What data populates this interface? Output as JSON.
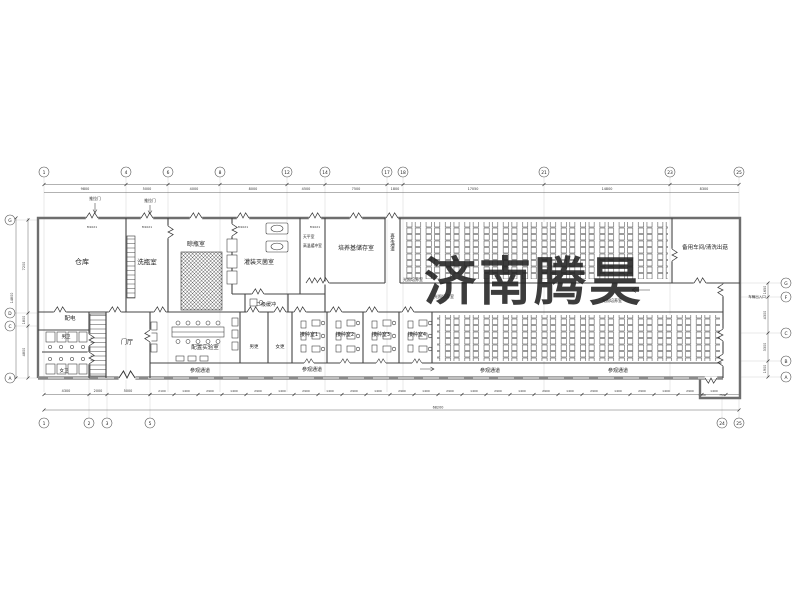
{
  "watermark": {
    "text": "济南腾昊",
    "color": "#e04848"
  },
  "colors": {
    "watermark_red": "#e04848",
    "wall_gray": "#6e6e6e",
    "line_dark": "#444"
  },
  "rooms": {
    "warehouse": "仓库",
    "bottle_wash": "洗瓶室",
    "bottle_dry": "晾瓶室",
    "filling_sterilize": "灌装灭菌室",
    "medium_storage": "培养基储存室",
    "spare_workshop": "备用车间/清洗出菇",
    "power_room": "配电",
    "wc_men": "男卫",
    "wc_women": "女卫",
    "lobby": "门厅",
    "prep_lab": "配置实验室",
    "buffer2": "二级缓冲",
    "change_men": "男更",
    "change_women": "女更",
    "inoc1": "接种室1",
    "inoc2": "接种室2",
    "inoc3": "接种室3",
    "inoc4": "接种室4"
  },
  "corridors": {
    "regen": "再生通道",
    "visitor": [
      "参观通道",
      "参观通道",
      "参观通道",
      "参观通道"
    ],
    "light_room": [
      "光照培养室",
      "光照培养室",
      "光照培养室"
    ]
  },
  "small_labels": {
    "sliding_door": [
      "推拉门",
      "推拉门"
    ],
    "balance_room": "天平室",
    "hot_buffer": "高温缓冲室",
    "vehicle_entry": "车辆出入口",
    "door_tag": "M1021"
  },
  "grid": {
    "top": [
      {
        "n": "1",
        "x": 44
      },
      {
        "n": "4",
        "x": 126
      },
      {
        "n": "6",
        "x": 168
      },
      {
        "n": "8",
        "x": 220
      },
      {
        "n": "12",
        "x": 287
      },
      {
        "n": "14",
        "x": 325
      },
      {
        "n": "17",
        "x": 387
      },
      {
        "n": "18",
        "x": 403
      },
      {
        "n": "21",
        "x": 544
      },
      {
        "n": "23",
        "x": 670
      },
      {
        "n": "25",
        "x": 739
      }
    ],
    "bottom": [
      {
        "n": "1",
        "x": 44
      },
      {
        "n": "2",
        "x": 89
      },
      {
        "n": "3",
        "x": 107
      },
      {
        "n": "5",
        "x": 150
      },
      {
        "n": "24",
        "x": 722
      },
      {
        "n": "25",
        "x": 739
      }
    ],
    "left": [
      {
        "n": "G",
        "y": 220
      },
      {
        "n": "D",
        "y": 313
      },
      {
        "n": "C",
        "y": 326
      },
      {
        "n": "A",
        "y": 378
      }
    ],
    "right": [
      {
        "n": "G",
        "y": 283
      },
      {
        "n": "F",
        "y": 297
      },
      {
        "n": "C",
        "y": 333
      },
      {
        "n": "B",
        "y": 361
      },
      {
        "n": "A",
        "y": 377
      }
    ]
  },
  "dims": {
    "top": [
      "9800",
      "5000",
      "4000",
      "8000",
      "4500",
      "7500",
      "1800",
      "17050",
      "14800",
      "8300"
    ],
    "bottom_left": [
      "4300",
      "2000",
      "5000"
    ],
    "bottom_small": [
      "2100",
      "1400",
      "2900",
      "1400",
      "2900",
      "1400",
      "2900",
      "1400",
      "2900",
      "1400",
      "2900",
      "1400",
      "2900",
      "1400",
      "2900",
      "1400",
      "2900",
      "1400",
      "2900",
      "1400",
      "2900",
      "1400",
      "2900",
      "1400"
    ],
    "total": "68200",
    "left": [
      "7200",
      "1800",
      "4800"
    ],
    "left_total": "14800",
    "right": [
      "1650",
      "4300",
      "3300",
      "1900"
    ],
    "vestibule": [
      "1400",
      "750"
    ]
  }
}
